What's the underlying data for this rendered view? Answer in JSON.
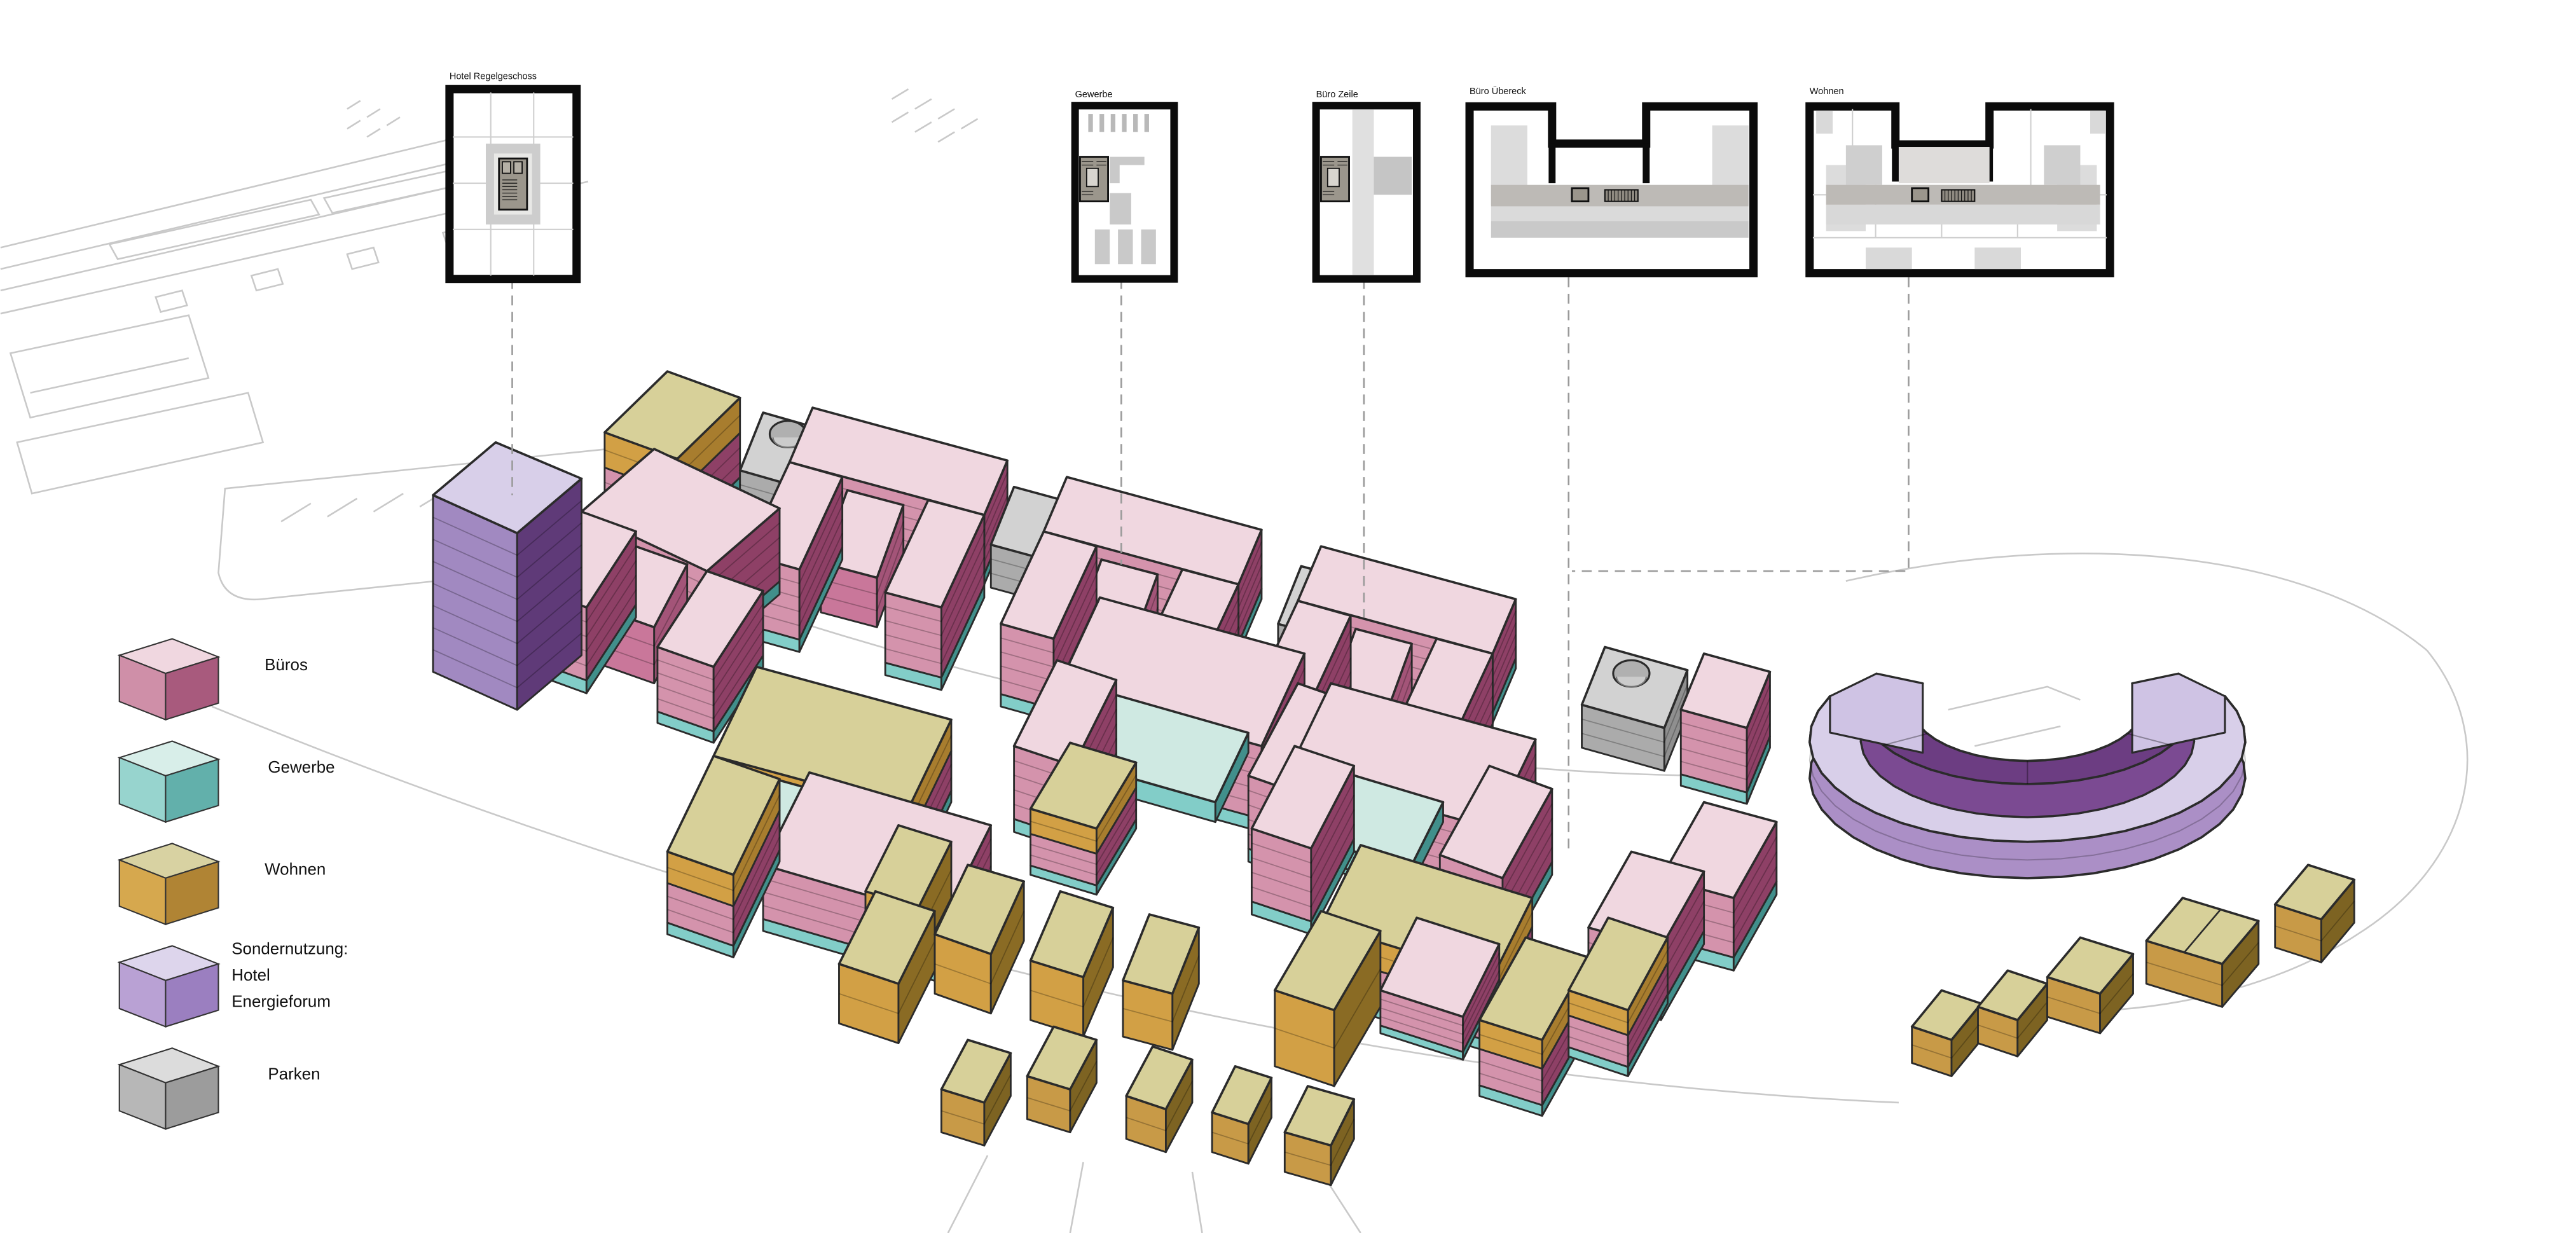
{
  "diagram": {
    "type": "urban-masterplan-axonometric",
    "floor_plans": [
      {
        "id": "hotel-regelgeschoss",
        "label": "Hotel Regelgeschoss"
      },
      {
        "id": "gewerbe",
        "label": "Gewerbe"
      },
      {
        "id": "buero-zeile",
        "label": "Büro Zeile"
      },
      {
        "id": "buero-uebereck",
        "label": "Büro Übereck"
      },
      {
        "id": "wohnen",
        "label": "Wohnen"
      }
    ],
    "legend": {
      "items": [
        {
          "label": "Büros",
          "colors": {
            "top": "#f0d7e0",
            "left": "#cf8fa8",
            "right": "#a85a7d"
          }
        },
        {
          "label": "Gewerbe",
          "colors": {
            "top": "#d8eee9",
            "left": "#97d4ce",
            "right": "#62b0ab"
          }
        },
        {
          "label": "Wohnen",
          "colors": {
            "top": "#d8d2a2",
            "left": "#d6a84e",
            "right": "#b08434"
          }
        },
        {
          "label_lines": [
            "Sondernutzung:",
            "Hotel",
            "Energieforum"
          ],
          "colors": {
            "top": "#ddd5ec",
            "left": "#b9a1d4",
            "right": "#9b7fc0"
          }
        },
        {
          "label": "Parken",
          "colors": {
            "top": "#dcdcdc",
            "left": "#b7b7b7",
            "right": "#9c9c9c"
          }
        }
      ]
    },
    "palette": {
      "pinkTop": "#f0d7e0",
      "pinkL": "#d493ac",
      "pinkR": "#8e4066",
      "pinkInL": "#c9779a",
      "pinkInR": "#a35478",
      "tealL": "#82cdc8",
      "tealR": "#418f8b",
      "mintTop": "#cfe9e2",
      "tanTop": "#d7d099",
      "goldL": "#d2a045",
      "goldR": "#a87d2e",
      "tanDarkR": "#8a6b24",
      "cubeGoldL": "#c89a47",
      "cubeBrownR": "#7d6322",
      "grayTop": "#d2d2d2",
      "grayL": "#ababab",
      "grayR": "#8f8f8f",
      "puTop": "#d8cfe9",
      "puL": "#a189c1",
      "puR": "#5f3a78",
      "puWall": "#ab8fc6",
      "puDark": "#6c3d82",
      "puMid": "#7b4a92",
      "puCap": "#cfc3e4",
      "outline": "#2b2b2b",
      "siteLine": "#c9c9c9"
    }
  }
}
